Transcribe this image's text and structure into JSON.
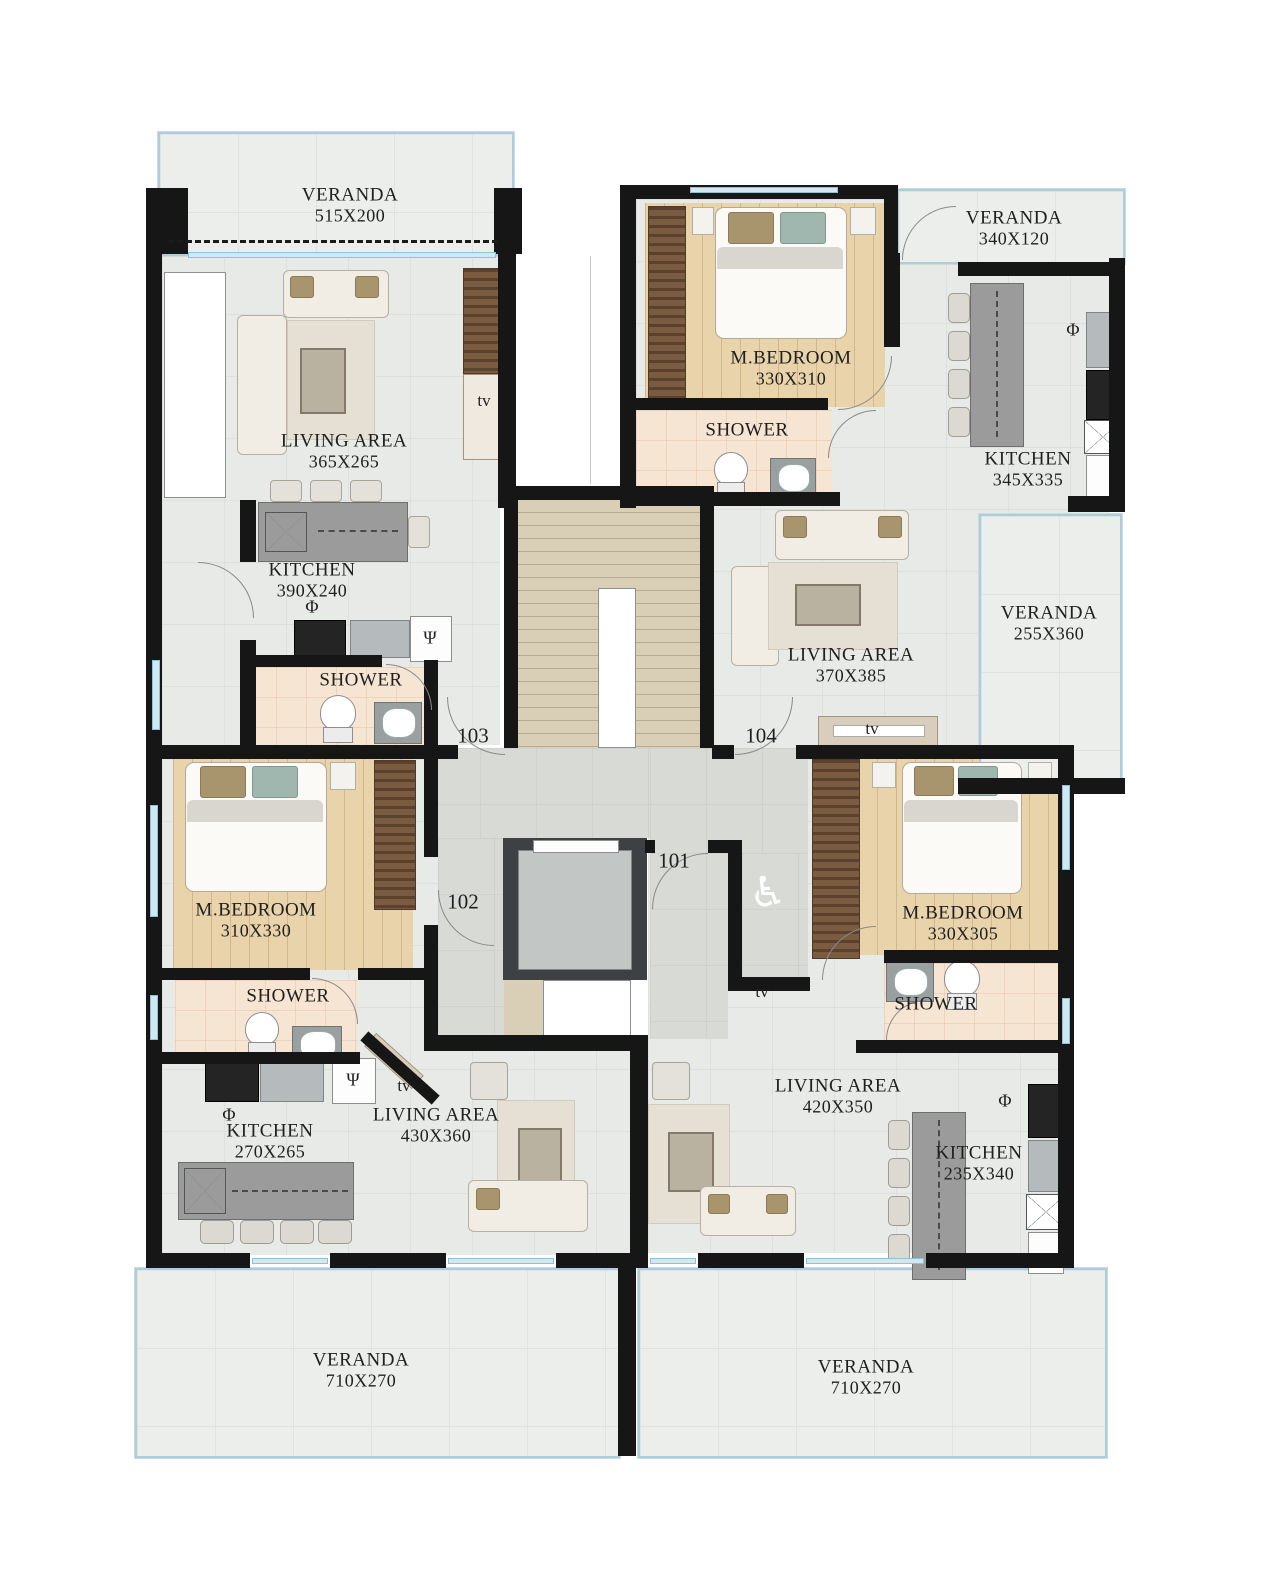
{
  "plan_type": "apartment floor plan",
  "palette": {
    "wall": "#161616",
    "tile_floor": "#e8eae7",
    "corridor_floor": "#d8dad6",
    "wood_floor": "#e9d3aa",
    "shower_floor": "#f7e5d3",
    "stairs": "#d9cfb6",
    "veranda_edge": "#a9cedd",
    "counter": "#9b9b9b",
    "elevator": "#3d4144"
  },
  "rooms": {
    "veranda_tl": {
      "name": "VERANDA",
      "dims": "515X200"
    },
    "living_tl": {
      "name": "LIVING AREA",
      "dims": "365X265"
    },
    "kitchen_tl": {
      "name": "KITCHEN",
      "dims": "390X240"
    },
    "shower_tl": {
      "name": "SHOWER"
    },
    "mbedroom_tr": {
      "name": "M.BEDROOM",
      "dims": "330X310"
    },
    "shower_tr": {
      "name": "SHOWER"
    },
    "veranda_tr": {
      "name": "VERANDA",
      "dims": "340X120"
    },
    "kitchen_tr": {
      "name": "KITCHEN",
      "dims": "345X335"
    },
    "veranda_r": {
      "name": "VERANDA",
      "dims": "255X360"
    },
    "living_tr": {
      "name": "LIVING AREA",
      "dims": "370X385"
    },
    "mbedroom_bl": {
      "name": "M.BEDROOM",
      "dims": "310X330"
    },
    "shower_bl": {
      "name": "SHOWER"
    },
    "kitchen_bl": {
      "name": "KITCHEN",
      "dims": "270X265"
    },
    "living_bl": {
      "name": "LIVING AREA",
      "dims": "430X360"
    },
    "living_br": {
      "name": "LIVING AREA",
      "dims": "420X350"
    },
    "kitchen_br": {
      "name": "KITCHEN",
      "dims": "235X340"
    },
    "mbedroom_br": {
      "name": "M.BEDROOM",
      "dims": "330X305"
    },
    "shower_br": {
      "name": "SHOWER"
    },
    "veranda_bl": {
      "name": "VERANDA",
      "dims": "710X270"
    },
    "veranda_br": {
      "name": "VERANDA",
      "dims": "710X270"
    }
  },
  "units": {
    "u101": "101",
    "u102": "102",
    "u103": "103",
    "u104": "104"
  },
  "labels": {
    "tv": "tv",
    "phi": "Φ",
    "psi": "Ψ",
    "wheelchair": "♿"
  }
}
